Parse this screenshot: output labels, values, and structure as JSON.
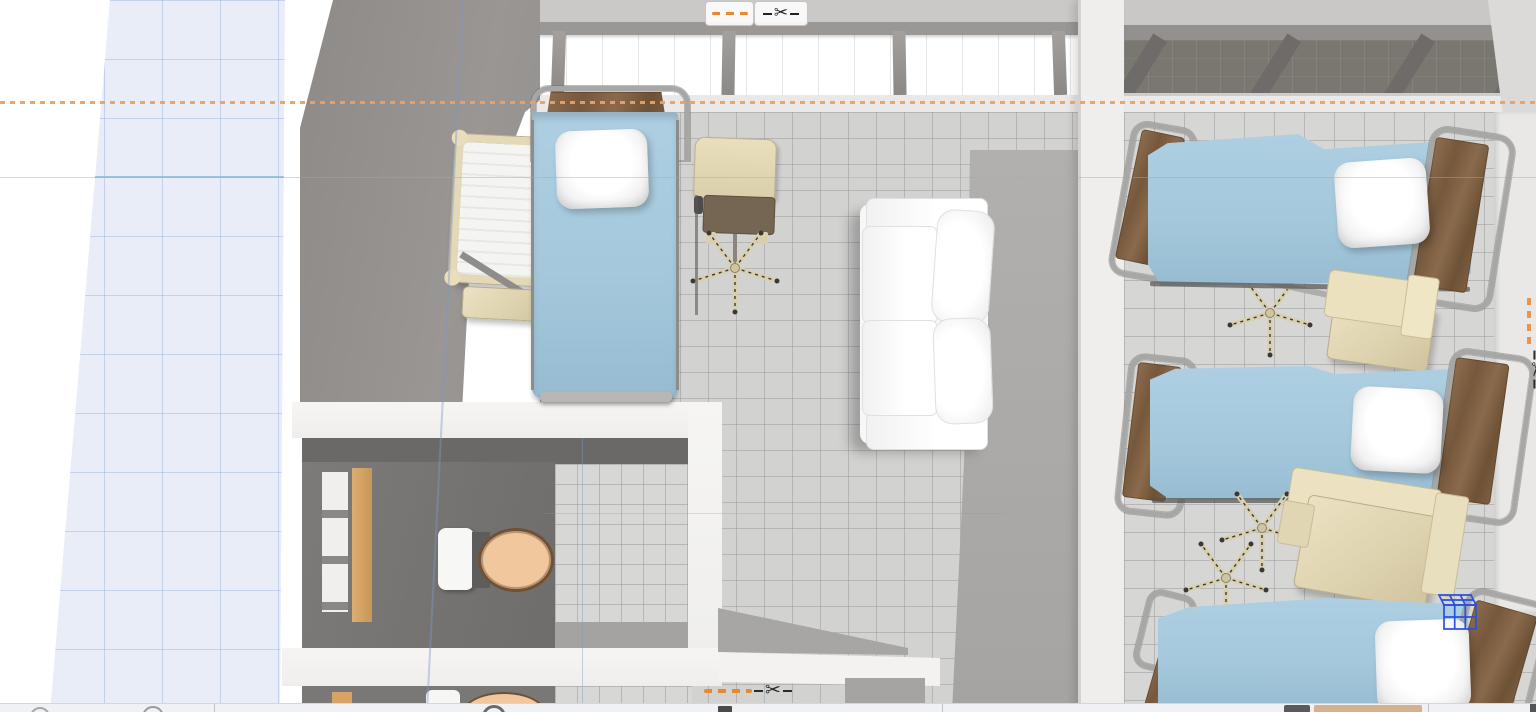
{
  "app": {
    "name": "3d-floor-plan-viewport",
    "description": "Overhead 3D view of a hospital ward floor plan with clip-plane controls"
  },
  "icons": {
    "scissors_glyph": "✂",
    "clip_dashes": "orange-dashed-clip-line",
    "status_circles": [
      "circle-button",
      "circle-button",
      "circle-button"
    ]
  },
  "controls": {
    "top": {
      "clip_button": "clip-plane-line",
      "cut_button": "scissors-cut"
    },
    "bottom": {
      "clip_marker": "clip-plane-line",
      "cut_marker": "scissors-cut"
    },
    "right": {
      "clip_marker": "clip-plane-line-vertical",
      "cut_marker": "scissors-cut-vertical"
    }
  },
  "colors": {
    "accent_orange": "#E8882F",
    "selection_blue": "#2B50DD",
    "bed_blanket_blue": "#A9CADC",
    "wood_brown": "#80624A",
    "furniture_beige": "#DFD5B3",
    "wall_gray": "#928F8D",
    "floor_tile_gray": "#D3D3D3",
    "grid_plane_blue": "#E9EDF8",
    "sofa_white": "#FAFAFA",
    "toilet_seat_tan": "#F0C89E",
    "window_glass_beige": "#C7BD9F",
    "window_glass_dark": "#79776F"
  },
  "scene": {
    "left_room": {
      "objects": [
        "hospital-bed",
        "pillow",
        "baby-crib",
        "desk-chair",
        "office-chair-base",
        "sofa"
      ]
    },
    "bathrooms": [
      {
        "objects": [
          "toilet",
          "shelf-unit",
          "wood-panel"
        ]
      },
      {
        "objects": [
          "toilet",
          "shelf-unit",
          "wood-panel"
        ]
      }
    ],
    "right_ward": {
      "objects": [
        "hospital-bed",
        "hospital-bed",
        "hospital-bed",
        "pillow",
        "pillow",
        "pillow",
        "office-chair-base",
        "office-chair-base",
        "office-chair-base",
        "bedside-cabinet",
        "bedside-cabinet"
      ]
    },
    "selection_indicator": "blue-wireframe-box",
    "grid_visible": true
  }
}
